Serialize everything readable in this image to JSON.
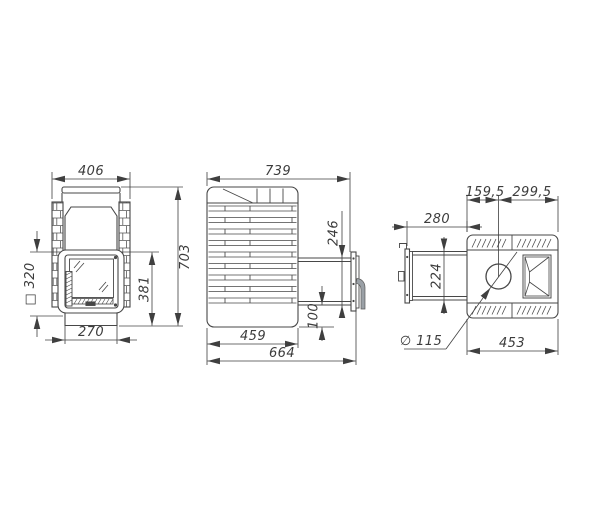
{
  "drawing_title": "sauna stove three-view technical drawing",
  "colors": {
    "line": "#474747",
    "dimension_line": "#3f3f3f",
    "handle_fill": "#9aa0a6",
    "background": "#ffffff"
  },
  "views": {
    "front": {
      "dim_width_top": "406",
      "dim_height_total": "703",
      "dim_door_height": "381",
      "dim_base_width": "270",
      "dim_square_opening": "□ 320"
    },
    "side": {
      "dim_depth_total_top": "739",
      "dim_opening_height": "246",
      "dim_bottom_offset": "100",
      "dim_body_depth": "459",
      "dim_overall_depth": "664"
    },
    "top": {
      "dim_chimney_offset_left": "159,5",
      "dim_chimney_offset_right": "299,5",
      "dim_tunnel_length": "280",
      "dim_tunnel_width": "224",
      "dim_chimney_diameter": "∅ 115",
      "dim_body_width": "453"
    }
  }
}
